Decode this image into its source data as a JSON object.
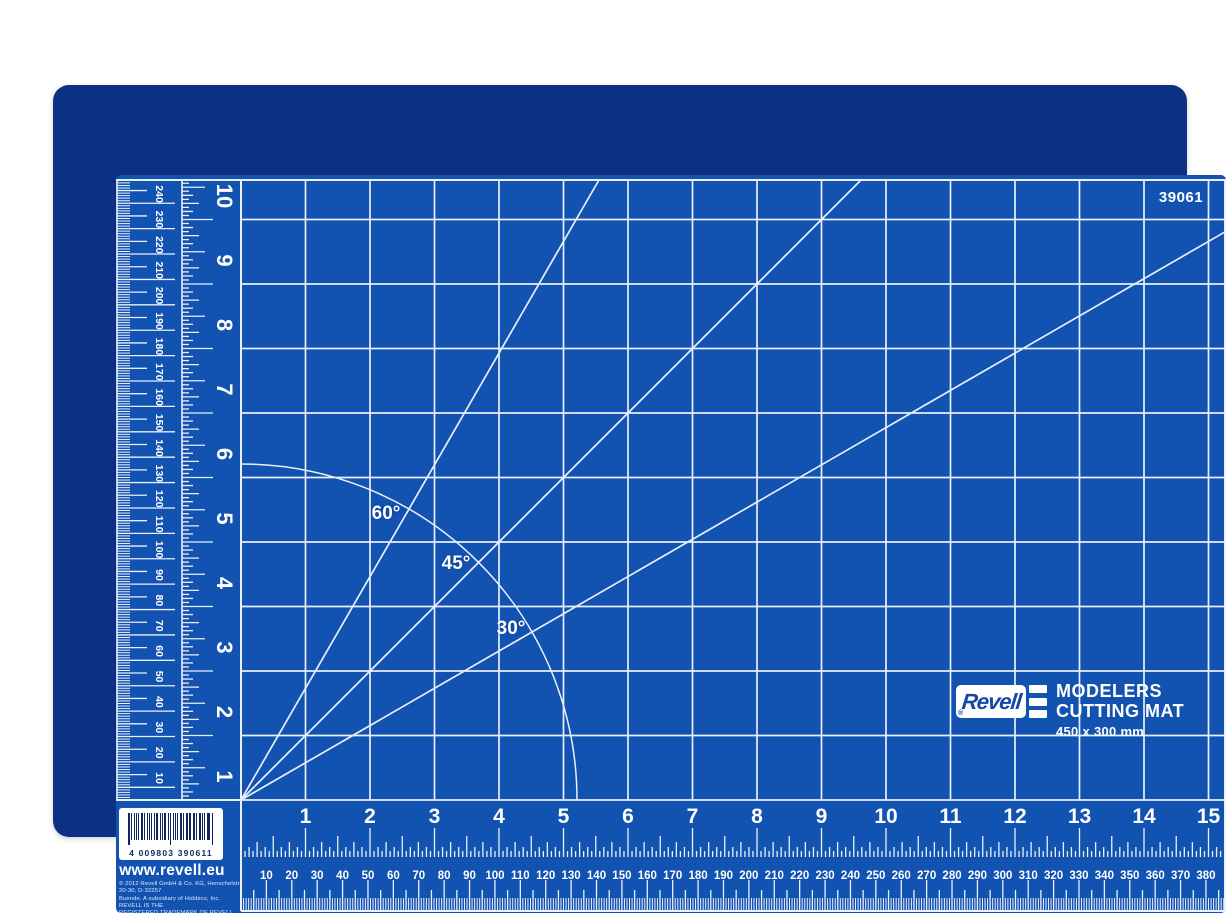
{
  "product_code": "39061",
  "branding": {
    "logo_text": "Revell",
    "registered_mark": "®",
    "title_line1": "MODELERS",
    "title_line2": "CUTTING MAT",
    "size_label": "450 x 300 mm"
  },
  "angle_guides": [
    {
      "label": "60°",
      "degrees": 60
    },
    {
      "label": "45°",
      "degrees": 45
    },
    {
      "label": "30°",
      "degrees": 30
    }
  ],
  "rulers": {
    "left_inch_labels": [
      "1",
      "2",
      "3",
      "4",
      "5",
      "6",
      "7",
      "8",
      "9",
      "10"
    ],
    "bottom_inch_labels": [
      "1",
      "2",
      "3",
      "4",
      "5",
      "6",
      "7",
      "8",
      "9",
      "10",
      "11",
      "12",
      "13",
      "14",
      "15"
    ],
    "left_mm_labels": [
      "10",
      "20",
      "30",
      "40",
      "50",
      "60",
      "70",
      "80",
      "90",
      "100",
      "110",
      "120",
      "130",
      "140",
      "150",
      "160",
      "170",
      "180",
      "190",
      "200",
      "210",
      "220",
      "230",
      "240"
    ],
    "bottom_mm_labels": [
      "10",
      "20",
      "30",
      "40",
      "50",
      "60",
      "70",
      "80",
      "90",
      "100",
      "110",
      "120",
      "130",
      "140",
      "150",
      "160",
      "170",
      "180",
      "190",
      "200",
      "210",
      "220",
      "230",
      "240",
      "250",
      "260",
      "270",
      "280",
      "290",
      "300",
      "310",
      "320",
      "330",
      "340",
      "350",
      "360",
      "370",
      "380"
    ]
  },
  "barcode": {
    "digits": "4 009803 390611"
  },
  "website": "www.revell.eu",
  "copyright_lines": [
    "© 2012 Revell GmbH & Co. KG, Henschelstr. 20-30, D-32257",
    "Buende. A subsidiary of Hobbico, Inc. REVELL IS THE",
    "REGISTERED TRADEMARK OF REVELL GMBH & CO. KG,",
    "GERMANY. Made in Taiwan"
  ],
  "colors": {
    "mat_border": "#0c3184",
    "mat_field": "#1252b1",
    "grid_line": "#e9f0fb",
    "text": "#ffffff",
    "logo_blue": "#1547a9"
  }
}
